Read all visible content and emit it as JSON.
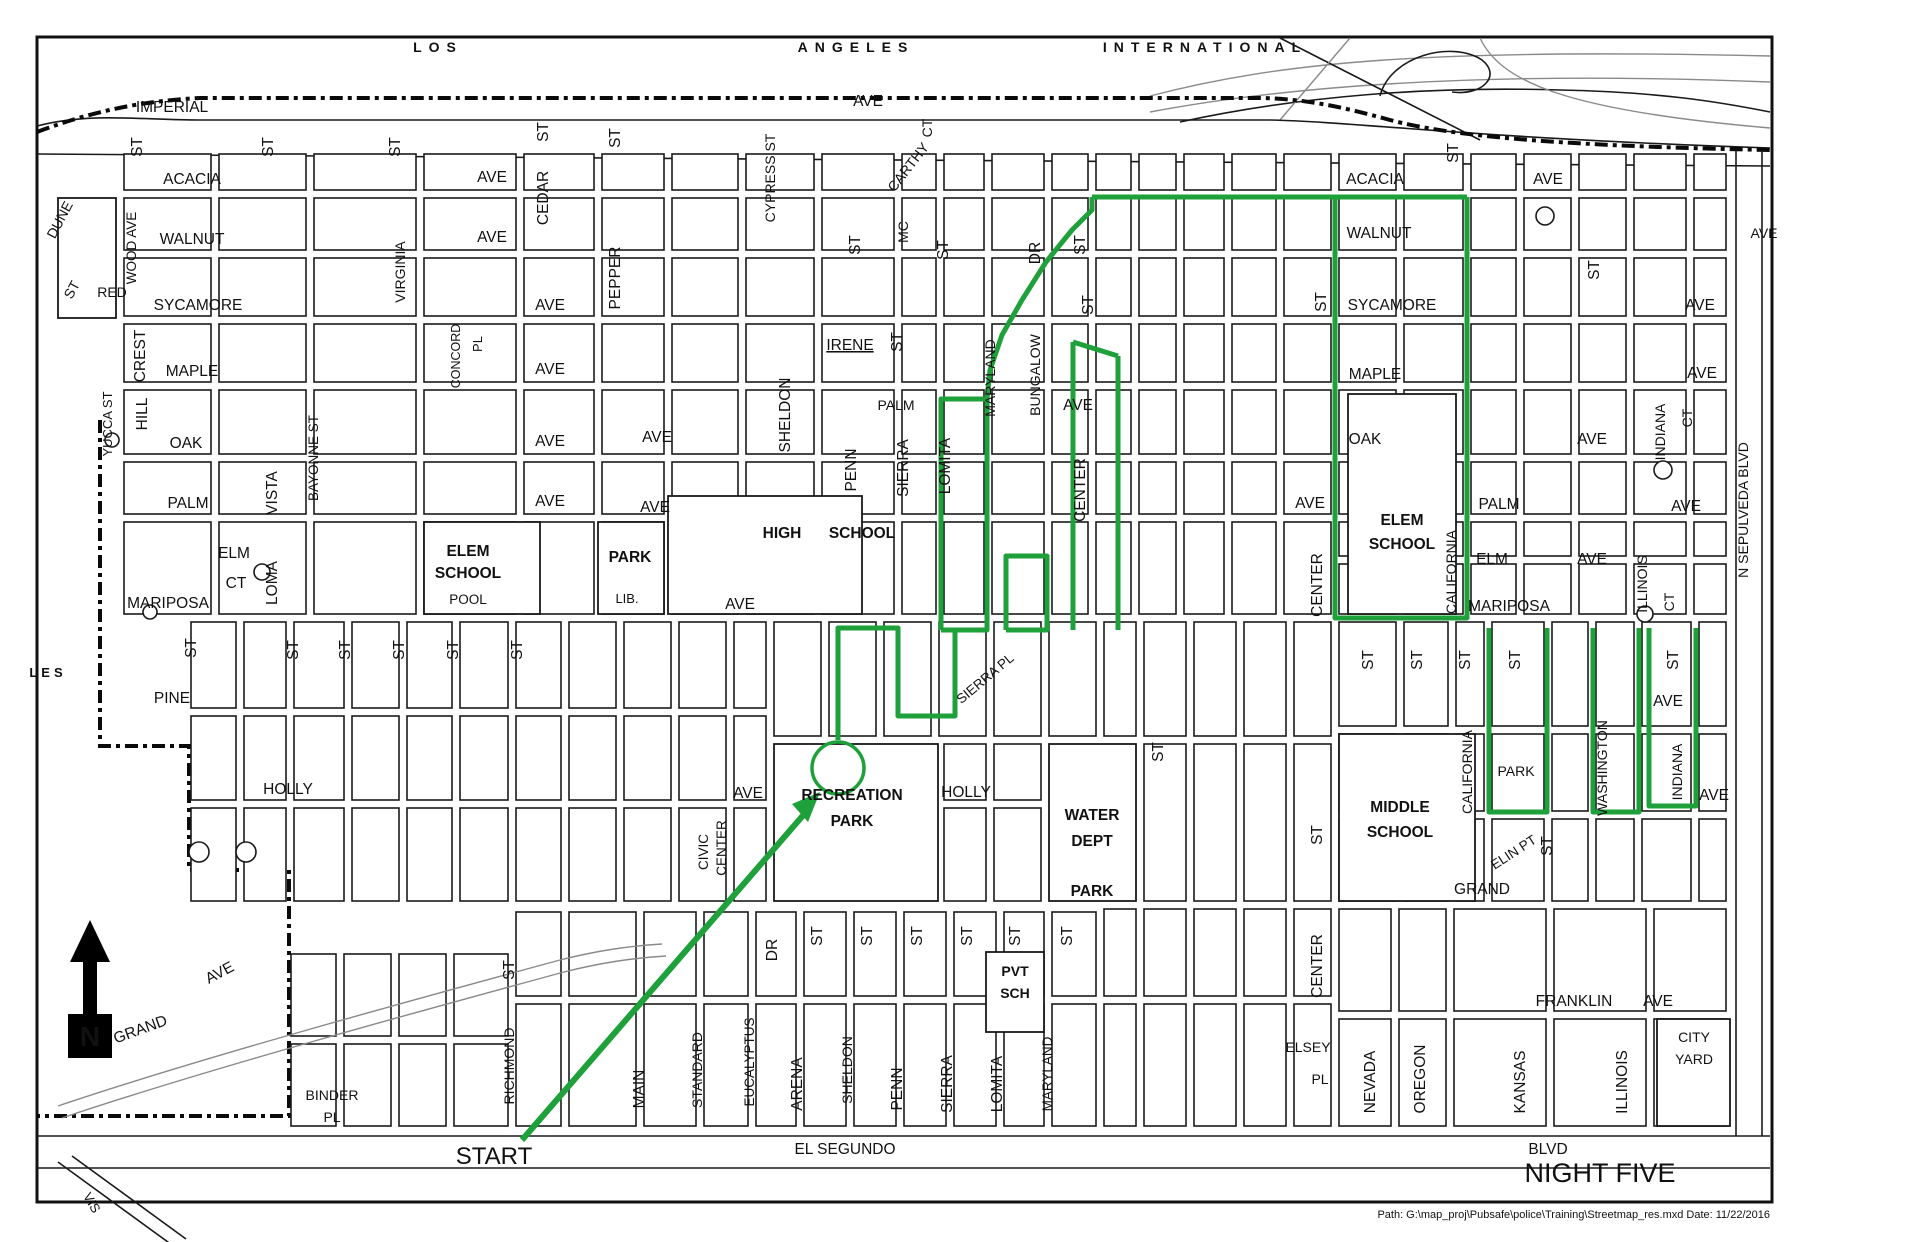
{
  "map": {
    "route": {
      "color": "#1EA03A",
      "width": 5,
      "polylines": [
        [
          838,
          740,
          838,
          628,
          898,
          628,
          898,
          716,
          955,
          716,
          955,
          630
        ],
        [
          941,
          630,
          941,
          399,
          987,
          399,
          987,
          630,
          941,
          630
        ],
        [
          1006,
          630,
          1006,
          556,
          1047,
          556,
          1047,
          630,
          1006,
          630
        ],
        [
          1073,
          342,
          1073,
          630
        ],
        [
          1118,
          356,
          1118,
          630
        ],
        [
          1073,
          342,
          1118,
          356
        ],
        [
          987,
          399,
          990,
          370,
          1002,
          335,
          1022,
          300,
          1046,
          262,
          1072,
          230,
          1092,
          210,
          1092,
          197
        ],
        [
          1092,
          197,
          1467,
          197
        ],
        [
          1335,
          197,
          1335,
          618,
          1467,
          618,
          1467,
          197
        ],
        [
          1489,
          628,
          1489,
          812,
          1547,
          812,
          1547,
          628
        ],
        [
          1593,
          628,
          1593,
          812,
          1639,
          812,
          1639,
          628
        ],
        [
          1649,
          628,
          1649,
          806,
          1696,
          806,
          1696,
          628
        ]
      ],
      "circle": {
        "cx": 838,
        "cy": 768,
        "r": 26
      },
      "arrow_line": [
        522,
        1140,
        806,
        812
      ],
      "arrow_head": "820,792 792,804 808,822"
    },
    "labels": [
      {
        "t": "LOS",
        "x": 438,
        "y": 52,
        "b": 1,
        "ls": 7,
        "s": 14,
        "n": "airport-title-los"
      },
      {
        "t": "ANGELES",
        "x": 856,
        "y": 52,
        "b": 1,
        "ls": 7,
        "s": 14,
        "n": "airport-title-angeles"
      },
      {
        "t": "INTERNATIONAL",
        "x": 1205,
        "y": 52,
        "b": 1,
        "ls": 7,
        "s": 14,
        "n": "airport-title-international"
      },
      {
        "t": "IMPERIAL",
        "x": 172,
        "y": 112
      },
      {
        "t": "AVE",
        "x": 868,
        "y": 106
      },
      {
        "t": "ACACIA",
        "x": 192,
        "y": 184
      },
      {
        "t": "AVE",
        "x": 492,
        "y": 182
      },
      {
        "t": "WALNUT",
        "x": 192,
        "y": 244
      },
      {
        "t": "AVE",
        "x": 492,
        "y": 242
      },
      {
        "t": "SYCAMORE",
        "x": 198,
        "y": 310
      },
      {
        "t": "AVE",
        "x": 550,
        "y": 310
      },
      {
        "t": "MAPLE",
        "x": 192,
        "y": 376
      },
      {
        "t": "AVE",
        "x": 550,
        "y": 374
      },
      {
        "t": "OAK",
        "x": 186,
        "y": 448
      },
      {
        "t": "AVE",
        "x": 550,
        "y": 446
      },
      {
        "t": "PALM",
        "x": 188,
        "y": 508
      },
      {
        "t": "AVE",
        "x": 550,
        "y": 506
      },
      {
        "t": "ELM",
        "x": 234,
        "y": 558
      },
      {
        "t": "CT",
        "x": 236,
        "y": 588
      },
      {
        "t": "MARIPOSA",
        "x": 168,
        "y": 608
      },
      {
        "t": "PINE",
        "x": 172,
        "y": 703
      },
      {
        "t": "HOLLY",
        "x": 288,
        "y": 794
      },
      {
        "t": "LES",
        "x": 48,
        "y": 677,
        "b": 1,
        "ls": 4,
        "s": 13
      },
      {
        "t": "DUNE",
        "x": 64,
        "y": 222,
        "r": -62,
        "s": 14
      },
      {
        "t": "ST",
        "x": 76,
        "y": 292,
        "r": -62,
        "s": 14
      },
      {
        "t": "RED",
        "x": 112,
        "y": 297,
        "s": 14
      },
      {
        "t": "WOOD AVE",
        "x": 136,
        "y": 248,
        "r": -90,
        "s": 13.5
      },
      {
        "t": "CREST",
        "x": 145,
        "y": 356,
        "r": -90
      },
      {
        "t": "HILL",
        "x": 147,
        "y": 414,
        "r": -90
      },
      {
        "t": "YUCCA ST",
        "x": 112,
        "y": 424,
        "r": -90,
        "s": 13
      },
      {
        "t": "VISTA",
        "x": 277,
        "y": 493,
        "r": -90
      },
      {
        "t": "LOMA",
        "x": 277,
        "y": 583,
        "r": -90
      },
      {
        "t": "BAYONNE ST",
        "x": 318,
        "y": 458,
        "r": -90,
        "s": 13.5
      },
      {
        "t": "VIRGINIA",
        "x": 405,
        "y": 272,
        "r": -90,
        "s": 14
      },
      {
        "t": "CONCORD",
        "x": 460,
        "y": 356,
        "r": -90,
        "s": 12.5
      },
      {
        "t": "PL",
        "x": 482,
        "y": 344,
        "r": -90,
        "s": 13
      },
      {
        "t": "ST",
        "x": 142,
        "y": 147,
        "r": -90
      },
      {
        "t": "ST",
        "x": 273,
        "y": 147,
        "r": -90
      },
      {
        "t": "ST",
        "x": 400,
        "y": 147,
        "r": -90
      },
      {
        "t": "ST",
        "x": 548,
        "y": 132,
        "r": -90
      },
      {
        "t": "CEDAR",
        "x": 548,
        "y": 198,
        "r": -90
      },
      {
        "t": "ST",
        "x": 620,
        "y": 138,
        "r": -90
      },
      {
        "t": "PEPPER",
        "x": 620,
        "y": 278,
        "r": -90
      },
      {
        "t": "CYPRESS ST",
        "x": 775,
        "y": 178,
        "r": -90,
        "s": 14
      },
      {
        "t": "MC",
        "x": 908,
        "y": 232,
        "r": -90,
        "s": 14
      },
      {
        "t": "CARTHY",
        "x": 912,
        "y": 170,
        "r": -52,
        "s": 14
      },
      {
        "t": "CT",
        "x": 932,
        "y": 128,
        "r": -90,
        "s": 14
      },
      {
        "t": "ST",
        "x": 860,
        "y": 245,
        "r": -90
      },
      {
        "t": "ST",
        "x": 948,
        "y": 250,
        "r": -90
      },
      {
        "t": "IRENE",
        "x": 850,
        "y": 350,
        "u": 1
      },
      {
        "t": "ST",
        "x": 902,
        "y": 342,
        "r": -90
      },
      {
        "t": "PALM",
        "x": 896,
        "y": 410,
        "s": 14
      },
      {
        "t": "SHELDON",
        "x": 790,
        "y": 415,
        "r": -90
      },
      {
        "t": "PENN",
        "x": 856,
        "y": 470,
        "r": -90
      },
      {
        "t": "SIERRA",
        "x": 908,
        "y": 468,
        "r": -90
      },
      {
        "t": "LOMITA",
        "x": 950,
        "y": 466,
        "r": -90
      },
      {
        "t": "MARYLAND",
        "x": 995,
        "y": 378,
        "r": -90,
        "s": 14
      },
      {
        "t": "BUNGALOW",
        "x": 1040,
        "y": 375,
        "r": -90,
        "s": 14
      },
      {
        "t": "AVE",
        "x": 1078,
        "y": 410
      },
      {
        "t": "DR",
        "x": 1040,
        "y": 253,
        "r": -90
      },
      {
        "t": "ST",
        "x": 1085,
        "y": 245,
        "r": -90
      },
      {
        "t": "ST",
        "x": 1093,
        "y": 305,
        "r": -90
      },
      {
        "t": "CENTER",
        "x": 1085,
        "y": 490,
        "r": -90
      },
      {
        "t": "ELEM",
        "x": 468,
        "y": 556,
        "b": 1
      },
      {
        "t": "SCHOOL",
        "x": 468,
        "y": 578,
        "b": 1
      },
      {
        "t": "POOL",
        "x": 468,
        "y": 604,
        "s": 13.5
      },
      {
        "t": "PARK",
        "x": 630,
        "y": 562,
        "b": 1
      },
      {
        "t": "LIB.",
        "x": 627,
        "y": 603,
        "s": 13
      },
      {
        "t": "HIGH",
        "x": 782,
        "y": 538,
        "b": 1
      },
      {
        "t": "SCHOOL",
        "x": 862,
        "y": 538,
        "b": 1
      },
      {
        "t": "AVE",
        "x": 657,
        "y": 442
      },
      {
        "t": "AVE",
        "x": 655,
        "y": 512
      },
      {
        "t": "AVE",
        "x": 740,
        "y": 609
      },
      {
        "t": "ST",
        "x": 196,
        "y": 648,
        "r": -90
      },
      {
        "t": "ST",
        "x": 298,
        "y": 650,
        "r": -90
      },
      {
        "t": "ST",
        "x": 350,
        "y": 650,
        "r": -90
      },
      {
        "t": "ST",
        "x": 404,
        "y": 650,
        "r": -90
      },
      {
        "t": "ST",
        "x": 458,
        "y": 650,
        "r": -90
      },
      {
        "t": "ST",
        "x": 522,
        "y": 650,
        "r": -90
      },
      {
        "t": "SIERRA PL",
        "x": 988,
        "y": 682,
        "r": -40,
        "s": 13.5
      },
      {
        "t": "RECREATION",
        "x": 852,
        "y": 800,
        "b": 1
      },
      {
        "t": "PARK",
        "x": 852,
        "y": 826,
        "b": 1
      },
      {
        "t": "HOLLY",
        "x": 966,
        "y": 797
      },
      {
        "t": "AVE",
        "x": 748,
        "y": 798
      },
      {
        "t": "WATER",
        "x": 1092,
        "y": 820,
        "b": 1
      },
      {
        "t": "DEPT",
        "x": 1092,
        "y": 846,
        "b": 1
      },
      {
        "t": "PARK",
        "x": 1092,
        "y": 896,
        "b": 1
      },
      {
        "t": "ST",
        "x": 1163,
        "y": 752,
        "r": -90
      },
      {
        "t": "ST",
        "x": 1322,
        "y": 835,
        "r": -90
      },
      {
        "t": "CIVIC",
        "x": 708,
        "y": 852,
        "r": -90,
        "s": 13.5
      },
      {
        "t": "CENTER",
        "x": 726,
        "y": 848,
        "r": -90,
        "s": 13.5
      },
      {
        "t": "ACACIA",
        "x": 1375,
        "y": 184
      },
      {
        "t": "AVE",
        "x": 1548,
        "y": 184
      },
      {
        "t": "WALNUT",
        "x": 1379,
        "y": 238
      },
      {
        "t": "SYCAMORE",
        "x": 1392,
        "y": 310
      },
      {
        "t": "AVE",
        "x": 1700,
        "y": 310
      },
      {
        "t": "MAPLE",
        "x": 1375,
        "y": 379
      },
      {
        "t": "AVE",
        "x": 1702,
        "y": 378
      },
      {
        "t": "OAK",
        "x": 1365,
        "y": 444
      },
      {
        "t": "AVE",
        "x": 1592,
        "y": 444
      },
      {
        "t": "PALM",
        "x": 1499,
        "y": 509
      },
      {
        "t": "ELM",
        "x": 1492,
        "y": 564
      },
      {
        "t": "AVE",
        "x": 1592,
        "y": 564
      },
      {
        "t": "MARIPOSA",
        "x": 1509,
        "y": 611
      },
      {
        "t": "AVE",
        "x": 1686,
        "y": 511
      },
      {
        "t": "INDIANA",
        "x": 1665,
        "y": 432,
        "r": -90,
        "s": 14
      },
      {
        "t": "CT",
        "x": 1692,
        "y": 418,
        "r": -90,
        "s": 14
      },
      {
        "t": "ILLINOIS",
        "x": 1647,
        "y": 584,
        "r": -90,
        "s": 14
      },
      {
        "t": "CT",
        "x": 1674,
        "y": 602,
        "r": -90,
        "s": 14
      },
      {
        "t": "ELEM",
        "x": 1402,
        "y": 525,
        "b": 1
      },
      {
        "t": "SCHOOL",
        "x": 1402,
        "y": 549,
        "b": 1
      },
      {
        "t": "CALIFORNIA",
        "x": 1456,
        "y": 572,
        "r": -90,
        "s": 14
      },
      {
        "t": "CENTER",
        "x": 1322,
        "y": 585,
        "r": -90
      },
      {
        "t": "AVE",
        "x": 1310,
        "y": 508
      },
      {
        "t": "ST",
        "x": 1326,
        "y": 302,
        "r": -90
      },
      {
        "t": "ST",
        "x": 1599,
        "y": 270,
        "r": -90
      },
      {
        "t": "ST",
        "x": 1458,
        "y": 153,
        "r": -90
      },
      {
        "t": "AVE",
        "x": 1764,
        "y": 238,
        "s": 14
      },
      {
        "t": "N  SEPULVEDA  BLVD",
        "x": 1748,
        "y": 510,
        "r": -90,
        "s": 14
      },
      {
        "t": "ST",
        "x": 1373,
        "y": 660,
        "r": -90
      },
      {
        "t": "ST",
        "x": 1422,
        "y": 660,
        "r": -90
      },
      {
        "t": "ST",
        "x": 1470,
        "y": 660,
        "r": -90
      },
      {
        "t": "ST",
        "x": 1520,
        "y": 660,
        "r": -90
      },
      {
        "t": "ST",
        "x": 1678,
        "y": 660,
        "r": -90
      },
      {
        "t": "AVE",
        "x": 1668,
        "y": 706
      },
      {
        "t": "WASHINGTON",
        "x": 1607,
        "y": 768,
        "r": -90,
        "s": 14
      },
      {
        "t": "CALIFORNIA",
        "x": 1472,
        "y": 772,
        "r": -90,
        "s": 14
      },
      {
        "t": "PARK",
        "x": 1516,
        "y": 776,
        "s": 14
      },
      {
        "t": "INDIANA",
        "x": 1682,
        "y": 772,
        "r": -90,
        "s": 14
      },
      {
        "t": "AVE",
        "x": 1714,
        "y": 800
      },
      {
        "t": "MIDDLE",
        "x": 1400,
        "y": 812,
        "b": 1
      },
      {
        "t": "SCHOOL",
        "x": 1400,
        "y": 837,
        "b": 1
      },
      {
        "t": "ELIN PT",
        "x": 1516,
        "y": 856,
        "r": -33,
        "s": 13.5
      },
      {
        "t": "GRAND",
        "x": 1482,
        "y": 894
      },
      {
        "t": "ST",
        "x": 1552,
        "y": 846,
        "r": -90
      },
      {
        "t": "FRANKLIN",
        "x": 1574,
        "y": 1006
      },
      {
        "t": "AVE",
        "x": 1658,
        "y": 1006
      },
      {
        "t": "CITY",
        "x": 1694,
        "y": 1042,
        "s": 14
      },
      {
        "t": "YARD",
        "x": 1694,
        "y": 1064,
        "s": 14
      },
      {
        "t": "CENTER",
        "x": 1322,
        "y": 966,
        "r": -90
      },
      {
        "t": "ELSEY",
        "x": 1308,
        "y": 1052,
        "s": 14
      },
      {
        "t": "PL",
        "x": 1320,
        "y": 1084,
        "s": 14
      },
      {
        "t": "NEVADA",
        "x": 1375,
        "y": 1082,
        "r": -90
      },
      {
        "t": "OREGON",
        "x": 1425,
        "y": 1079,
        "r": -90
      },
      {
        "t": "KANSAS",
        "x": 1525,
        "y": 1082,
        "r": -90
      },
      {
        "t": "ILLINOIS",
        "x": 1627,
        "y": 1082,
        "r": -90
      },
      {
        "t": "ST",
        "x": 514,
        "y": 970,
        "r": -90
      },
      {
        "t": "RICHMOND",
        "x": 514,
        "y": 1066,
        "r": -90,
        "s": 14
      },
      {
        "t": "DR",
        "x": 777,
        "y": 950,
        "r": -90
      },
      {
        "t": "ST",
        "x": 822,
        "y": 936,
        "r": -90
      },
      {
        "t": "ST",
        "x": 872,
        "y": 936,
        "r": -90
      },
      {
        "t": "ST",
        "x": 922,
        "y": 936,
        "r": -90
      },
      {
        "t": "ST",
        "x": 972,
        "y": 936,
        "r": -90
      },
      {
        "t": "ST",
        "x": 1020,
        "y": 936,
        "r": -90
      },
      {
        "t": "ST",
        "x": 1072,
        "y": 936,
        "r": -90
      },
      {
        "t": "MAIN",
        "x": 644,
        "y": 1089,
        "r": -90
      },
      {
        "t": "STANDARD",
        "x": 702,
        "y": 1070,
        "r": -90,
        "s": 14
      },
      {
        "t": "EUCALYPTUS",
        "x": 754,
        "y": 1062,
        "r": -90,
        "s": 13.5
      },
      {
        "t": "ARENA",
        "x": 802,
        "y": 1084,
        "r": -90
      },
      {
        "t": "SHELDON",
        "x": 852,
        "y": 1070,
        "r": -90,
        "s": 14
      },
      {
        "t": "PENN",
        "x": 902,
        "y": 1089,
        "r": -90
      },
      {
        "t": "SIERRA",
        "x": 952,
        "y": 1084,
        "r": -90
      },
      {
        "t": "LOMITA",
        "x": 1002,
        "y": 1084,
        "r": -90
      },
      {
        "t": "MARYLAND",
        "x": 1052,
        "y": 1074,
        "r": -90,
        "s": 13.5
      },
      {
        "t": "PVT",
        "x": 1015,
        "y": 976,
        "b": 1,
        "s": 14
      },
      {
        "t": "SCH",
        "x": 1015,
        "y": 998,
        "b": 1,
        "s": 14
      },
      {
        "t": "BINDER",
        "x": 332,
        "y": 1100,
        "s": 14
      },
      {
        "t": "PL",
        "x": 332,
        "y": 1122,
        "s": 14
      },
      {
        "t": "EL SEGUNDO",
        "x": 845,
        "y": 1154
      },
      {
        "t": "BLVD",
        "x": 1548,
        "y": 1154
      },
      {
        "t": "NIGHT FIVE",
        "x": 1600,
        "y": 1182,
        "c": "#C53050",
        "s": 27,
        "n": "night-five-label"
      },
      {
        "t": "START",
        "x": 494,
        "y": 1164,
        "s": 24,
        "n": "start-label"
      },
      {
        "t": "VIS",
        "x": 88,
        "y": 1205,
        "r": 60,
        "s": 13
      },
      {
        "t": "GRAND",
        "x": 142,
        "y": 1034,
        "r": -20
      },
      {
        "t": "AVE",
        "x": 222,
        "y": 977,
        "r": -28
      },
      {
        "t": "N",
        "x": 90,
        "y": 1046,
        "c": "#ffffff",
        "b": 1,
        "s": 28,
        "n": "north-arrow-letter"
      },
      {
        "t": "Path: G:\\map_proj\\Pubsafe\\police\\Training\\Streetmap_res.mxd    Date: 11/22/2016",
        "x": 1770,
        "y": 1218,
        "a": "end",
        "s": 11,
        "c": "#333333",
        "n": "footer-text"
      }
    ]
  }
}
